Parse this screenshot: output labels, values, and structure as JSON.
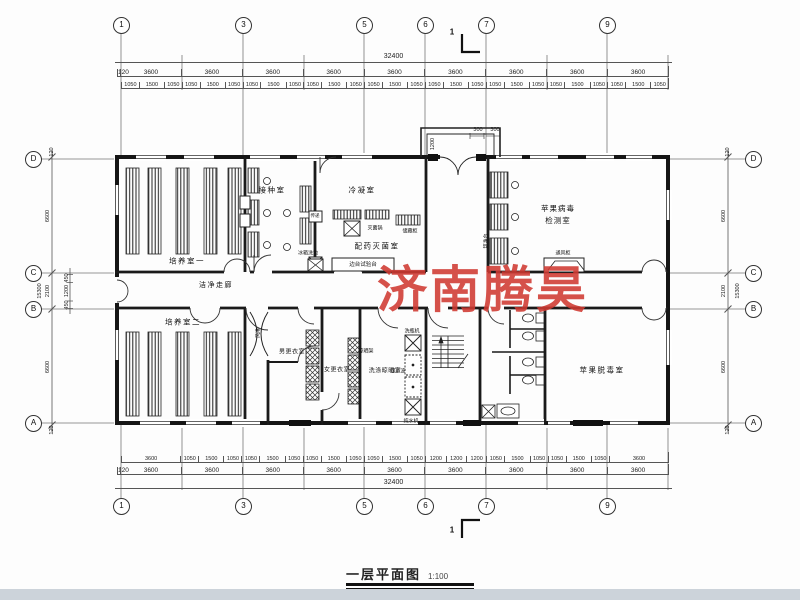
{
  "watermark": {
    "text": "济南腾昊",
    "color": "#d03a32"
  },
  "title": {
    "text": "一层平面图",
    "scale": "1:100"
  },
  "section_marks": {
    "top": "1",
    "bottom": "1"
  },
  "grid_bubbles": {
    "top": [
      "1",
      "3",
      "5",
      "6",
      "7",
      "9"
    ],
    "bottom": [
      "1",
      "3",
      "5",
      "6",
      "7",
      "9"
    ],
    "left": [
      "D",
      "C",
      "B",
      "A"
    ],
    "right": [
      "D",
      "C",
      "B",
      "A"
    ]
  },
  "dims": {
    "top_overall": "32400",
    "top_bays": [
      "120",
      "3600",
      "3600",
      "3600",
      "3600",
      "3600",
      "3600",
      "3600",
      "3600",
      "3600"
    ],
    "top_detail": [
      "1050",
      "1500",
      "1050",
      "1050",
      "1500",
      "1050",
      "1050",
      "1500",
      "1050",
      "1050",
      "1500",
      "1050",
      "1050",
      "1500",
      "1050",
      "1050",
      "1500",
      "1050",
      "1050",
      "1500",
      "1050",
      "1050",
      "1500",
      "1050",
      "1050",
      "1500",
      "1050"
    ],
    "bottom_overall": "32400",
    "bottom_bays": [
      "120",
      "3600",
      "3600",
      "3600",
      "3600",
      "3600",
      "3600",
      "3600",
      "3600",
      "3600"
    ],
    "bottom_detail": [
      "3600",
      "1050",
      "1500",
      "1050",
      "1050",
      "1500",
      "1050",
      "1050",
      "1500",
      "1050",
      "1050",
      "1500",
      "1050",
      "1200",
      "1200",
      "1200",
      "1050",
      "1500",
      "1050",
      "1050",
      "1500",
      "1050",
      "3600"
    ],
    "left_overall": "15300",
    "left_segments": {
      "edge_top": "120",
      "dc": "6600",
      "cb": "2100",
      "ba": "6600",
      "edge_bottom": "120"
    },
    "left_detail": [
      "450",
      "1200",
      "450"
    ],
    "right_overall": "15300",
    "right_segments": {
      "edge_top": "120",
      "dc": "6600",
      "cb": "2100",
      "ba": "6600",
      "edge_bottom": "120"
    },
    "vestibule": {
      "depth": "1200",
      "step1": "300",
      "step2": "300"
    }
  },
  "rooms": {
    "culture1": "培养室一",
    "inoculation": "接种室",
    "condensation": "冷凝室",
    "sterilization": "配药灭菌室",
    "virus_test_line1": "苹果病毒",
    "virus_test_line2": "检测室",
    "corridor": "洁净走廊",
    "culture2": "培养室二",
    "men_changing": "男更衣室",
    "women_changing": "女更衣室",
    "washing": "洗涤晾晒室",
    "detox": "苹果脱毒室"
  },
  "equipment": {
    "pass_window": "传递",
    "sterilizer": "灭菌锅",
    "cabinet": "储藏柜",
    "side_bench": "边台试验台",
    "sink": "洗池",
    "fridge": "冰箱",
    "clean_bench": "超净台",
    "fume_hood": "通风柜",
    "air_shower": "风淋",
    "drying_rack": "晾晒架",
    "bottle_washer": "洗瓶机",
    "ultrasonic": "超声波",
    "water_purifier": "纯水机"
  }
}
